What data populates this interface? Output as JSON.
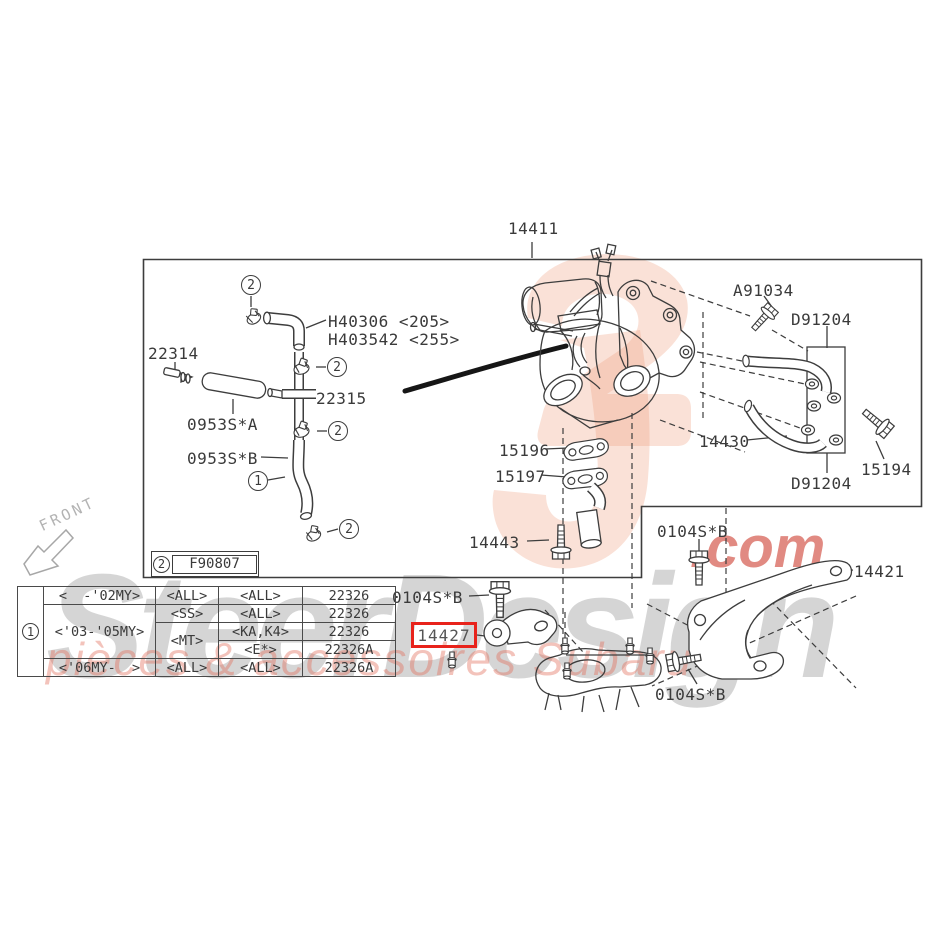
{
  "diagram": {
    "main_assembly": "14411",
    "figure_ref": "F90807",
    "front_label": "FRONT",
    "ref_1": "1",
    "ref_2": "2"
  },
  "callouts": {
    "main_assembly": "14411",
    "hose_205": "H40306 <205>",
    "hose_255": "H403542 <255>",
    "part_22314": "22314",
    "part_22315": "22315",
    "hose_a": "0953S*A",
    "hose_b": "0953S*B",
    "gasket_15196": "15196",
    "gasket_15197": "15197",
    "bolt_14443": "14443",
    "bolt_a91034": "A91034",
    "washer_d91204": "D91204",
    "pipe_14430": "14430",
    "bolt_15194": "15194",
    "bolt_0104s": "0104S*B",
    "bracket_14421": "14421",
    "bracket_14427": "14427"
  },
  "highlight": {
    "part_number": "14427",
    "color": "#e8231b"
  },
  "applicability_table": {
    "ref": "1",
    "columns": [
      "model_year",
      "transmission",
      "spec",
      "part_number"
    ],
    "rows": [
      {
        "model_year": "<  -'02MY>",
        "transmission": "<ALL>",
        "spec": "<ALL>",
        "part_number": "22326"
      },
      {
        "model_year": "<'03-'05MY>",
        "transmission": "<SS>",
        "spec": "<ALL>",
        "part_number": "22326"
      },
      {
        "model_year": "<'03-'05MY>",
        "transmission": "<MT>",
        "spec": "<KA,K4>",
        "part_number": "22326"
      },
      {
        "model_year": "<'03-'05MY>",
        "transmission": "<MT>",
        "spec": "<E*>",
        "part_number": "22326A"
      },
      {
        "model_year": "<'06MY-  >",
        "transmission": "<ALL>",
        "spec": "<ALL>",
        "part_number": "22326A"
      }
    ]
  },
  "watermark": {
    "brand": "SteerDesign",
    "domain_suffix": ".com",
    "tagline": "pièces & accessoires Subaru"
  },
  "colors": {
    "line": "#3d3d3d",
    "highlight_red": "#e8231b",
    "watermark_salmon": "#f09a7c",
    "watermark_gray": "#7d7d7d",
    "watermark_red": "#c92a1b"
  }
}
